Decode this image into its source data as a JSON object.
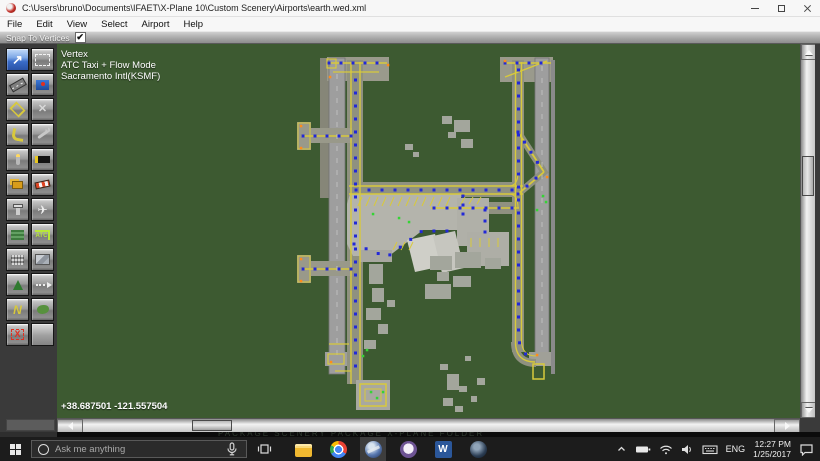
{
  "window": {
    "title": "C:\\Users\\bruno\\Documents\\IFAET\\X-Plane 10\\Custom Scenery\\Airports\\earth.wed.xml"
  },
  "menu": {
    "items": [
      "File",
      "Edit",
      "View",
      "Select",
      "Airport",
      "Help"
    ]
  },
  "snapbar": {
    "label": "Snap To Vertices",
    "checked": true,
    "check_glyph": "✔"
  },
  "palette": {
    "tools": [
      {
        "name": "vertex-tool",
        "label": "Vertex",
        "icon": "vertex",
        "glyph": "↗",
        "selected": true
      },
      {
        "name": "marquee-tool",
        "label": "Marquee",
        "icon": "marquee"
      },
      {
        "name": "runway-tool",
        "label": "Runway",
        "icon": "runway"
      },
      {
        "name": "sealane-tool",
        "label": "Sealane",
        "icon": "sealane"
      },
      {
        "name": "taxiway-tool",
        "label": "Taxiway",
        "icon": "taxiway"
      },
      {
        "name": "hole-tool",
        "label": "Hole",
        "icon": "hole",
        "glyph": "✕"
      },
      {
        "name": "taxiline-tool",
        "label": "Taxiline",
        "icon": "taxiline"
      },
      {
        "name": "boundary-tool",
        "label": "Boundary",
        "icon": "wrench"
      },
      {
        "name": "light-fixture-tool",
        "label": "Light Fixture",
        "icon": "light"
      },
      {
        "name": "sign-tool",
        "label": "Sign",
        "icon": "sign"
      },
      {
        "name": "object-tool",
        "label": "Object",
        "icon": "object"
      },
      {
        "name": "windsock-tool",
        "label": "Windsock",
        "icon": "windsock"
      },
      {
        "name": "tower-viewpoint-tool",
        "label": "Tower Viewpoint",
        "icon": "tower"
      },
      {
        "name": "ramp-start-tool",
        "label": "Ramp Start",
        "icon": "ramp",
        "glyph": "✈"
      },
      {
        "name": "orthophoto-tool",
        "label": "Orthophoto",
        "icon": "ortho"
      },
      {
        "name": "atc-taxi-route-tool",
        "label": "ATC Taxi Route",
        "icon": "atc",
        "glyph": "ATC"
      },
      {
        "name": "facade-tool",
        "label": "Facade",
        "icon": "facade"
      },
      {
        "name": "object-art-tool",
        "label": "Object Art",
        "icon": "objart"
      },
      {
        "name": "forest-tool",
        "label": "Forest",
        "icon": "forest"
      },
      {
        "name": "string-tool",
        "label": "String",
        "icon": "string"
      },
      {
        "name": "line-tool",
        "label": "Line",
        "icon": "line",
        "glyph": "N"
      },
      {
        "name": "polygon-tool",
        "label": "Polygon",
        "icon": "polygon"
      },
      {
        "name": "exclusion-zone-tool",
        "label": "Exclusion Zone",
        "icon": "exclusion",
        "glyph": "X"
      },
      {
        "name": "empty-slot",
        "label": "",
        "icon": "blank"
      }
    ]
  },
  "canvas": {
    "overlay": {
      "line1": "Vertex",
      "line2": "ATC Taxi + Flow Mode",
      "line3": "Sacramento Intl(KSMF)"
    },
    "coordinates": "+38.687501 -121.557504",
    "colors": {
      "background": "#3d5a31",
      "runway": "#9e9e9e",
      "taxi_yellow": "#d8c93c",
      "apron": "#b4b4ac",
      "node_blue": "#2228d8",
      "node_green": "#35d435",
      "node_orange": "#ff8c1a"
    },
    "map": {
      "shapes": [
        [
          "r",
          263,
          14,
          9,
          140,
          "#868678"
        ],
        [
          "r",
          270,
          13,
          62,
          24,
          "#9a9a8c"
        ],
        [
          "r",
          443,
          13,
          53,
          25,
          "#9a9a8c"
        ],
        [
          "r",
          272,
          14,
          16,
          316,
          "#9e9e9e",
          "#747474"
        ],
        [
          "r",
          290,
          16,
          16,
          324,
          "#8f9180"
        ],
        [
          "r",
          478,
          14,
          14,
          300,
          "#9e9e9e",
          "#747474"
        ],
        [
          "r",
          494,
          16,
          4,
          314,
          "#8a8a8a"
        ],
        [
          "r",
          455,
          16,
          12,
          292,
          "#8f9180"
        ],
        [
          "r",
          291,
          138,
          176,
          15,
          "#8f9180"
        ],
        [
          "r",
          373,
          158,
          93,
          12,
          "#8f9180"
        ],
        [
          "r",
          242,
          84,
          53,
          15,
          "#99998a"
        ],
        [
          "r",
          240,
          78,
          14,
          28,
          "#99998a"
        ],
        [
          "r",
          242,
          217,
          53,
          15,
          "#99998a"
        ],
        [
          "r",
          240,
          211,
          14,
          28,
          "#99998a"
        ],
        [
          "r",
          268,
          308,
          22,
          14,
          "#9e9e9e"
        ],
        [
          "r",
          472,
          308,
          22,
          14,
          "#a0a098"
        ],
        [
          "g",
          "293,150 404,150 404,186 366,186 332,212 296,212 290,200 290,160",
          "#b4b4ac"
        ],
        [
          "r",
          400,
          154,
          32,
          48,
          "#b0b0a8"
        ],
        [
          "r",
          410,
          188,
          42,
          34,
          "#aeaea6"
        ],
        [
          "r",
          303,
          206,
          32,
          12,
          "#a8a8a0"
        ],
        [
          "r",
          299,
          336,
          34,
          30,
          "#a8a8a0"
        ],
        [
          "g",
          "350,196 378,190 386,222 358,228",
          "#cfcfc8"
        ],
        [
          "g",
          "376,192 398,187 407,224 385,229",
          "#c6c6bf"
        ],
        [
          "r",
          385,
          72,
          10,
          8,
          "#a3a69c"
        ],
        [
          "r",
          397,
          76,
          16,
          12,
          "#a3a69c"
        ],
        [
          "r",
          391,
          88,
          8,
          6,
          "#a3a69c"
        ],
        [
          "r",
          404,
          95,
          12,
          9,
          "#a3a69c"
        ],
        [
          "r",
          348,
          100,
          8,
          6,
          "#a3a69c"
        ],
        [
          "r",
          356,
          108,
          6,
          5,
          "#a3a69c"
        ],
        [
          "r",
          373,
          212,
          22,
          14,
          "#a3a69c"
        ],
        [
          "r",
          398,
          208,
          26,
          16,
          "#a3a69c"
        ],
        [
          "r",
          428,
          214,
          16,
          11,
          "#a3a69c"
        ],
        [
          "r",
          380,
          228,
          12,
          9,
          "#a3a69c"
        ],
        [
          "r",
          368,
          240,
          26,
          15,
          "#a3a69c"
        ],
        [
          "r",
          396,
          232,
          18,
          11,
          "#a3a69c"
        ],
        [
          "r",
          312,
          220,
          14,
          20,
          "#a3a69c"
        ],
        [
          "r",
          315,
          244,
          12,
          14,
          "#a3a69c"
        ],
        [
          "r",
          309,
          264,
          15,
          12,
          "#a3a69c"
        ],
        [
          "r",
          321,
          280,
          10,
          10,
          "#a3a69c"
        ],
        [
          "r",
          307,
          296,
          12,
          9,
          "#a3a69c"
        ],
        [
          "r",
          330,
          256,
          8,
          7,
          "#a3a69c"
        ],
        [
          "r",
          383,
          320,
          8,
          6,
          "#a3a69c"
        ],
        [
          "r",
          390,
          330,
          12,
          16,
          "#a3a69c"
        ],
        [
          "r",
          402,
          342,
          8,
          6,
          "#a3a69c"
        ],
        [
          "r",
          386,
          354,
          10,
          8,
          "#a3a69c"
        ],
        [
          "r",
          398,
          362,
          8,
          6,
          "#a3a69c"
        ],
        [
          "r",
          408,
          312,
          6,
          5,
          "#a3a69c"
        ],
        [
          "r",
          420,
          334,
          8,
          7,
          "#a3a69c"
        ],
        [
          "r",
          414,
          352,
          6,
          6,
          "#a3a69c"
        ],
        [
          "p",
          "M461,88 L487,128 L461,150",
          "#8f9180",
          7
        ],
        [
          "p",
          "M458,298 C458,313 466,319 479,319",
          "#8f9180",
          8
        ],
        [
          "l",
          294,
          18,
          294,
          340,
          "Y",
          1.4
        ],
        [
          "l",
          303,
          18,
          303,
          336,
          "Y",
          1.4
        ],
        [
          "l",
          292,
          142,
          466,
          142,
          "Y",
          1.4
        ],
        [
          "l",
          292,
          150,
          466,
          150,
          "Y",
          1.4
        ],
        [
          "l",
          374,
          164,
          462,
          164,
          "Y",
          1.4
        ],
        [
          "l",
          458.5,
          18,
          458.5,
          298,
          "Y",
          1.4
        ],
        [
          "l",
          464.5,
          18,
          464.5,
          296,
          "Y",
          1.4
        ],
        [
          "l",
          244,
          92,
          295,
          92,
          "Y",
          1.4
        ],
        [
          "l",
          244,
          225,
          295,
          225,
          "Y",
          1.4
        ],
        [
          "l",
          272,
          19,
          330,
          19,
          "Y",
          1.4
        ],
        [
          "l",
          276,
          28,
          322,
          28,
          "Y",
          1.2
        ],
        [
          "l",
          446,
          19,
          494,
          19,
          "Y",
          1.4
        ],
        [
          "l",
          272,
          300,
          292,
          300,
          "Y",
          1.2
        ],
        [
          "l",
          278,
          327,
          294,
          327,
          "Y",
          1.2
        ],
        [
          "l",
          280,
          30,
          280,
          318,
          "#c6c6c6",
          0.8,
          "5,7"
        ],
        [
          "l",
          485,
          22,
          485,
          306,
          "#c6c6c6",
          0.8,
          "5,7"
        ],
        [
          "p",
          "M461,88 L487,128",
          "Y",
          1.8
        ],
        [
          "p",
          "M461,150 L487,128",
          "Y",
          1.8
        ],
        [
          "p",
          "M448,33 L490,17",
          "Y",
          1.4
        ],
        [
          "p",
          "M458.5,298 C458.5,312 466,318 478,318",
          "Y",
          1.4
        ],
        [
          "p",
          "M464.5,296 C464.5,307 470,312 479,312",
          "Y",
          1.1
        ],
        [
          "p",
          "M452,150 C460,150 461,158 461,164",
          "Y",
          1.1
        ],
        [
          "p",
          "M452,142 C460,142 461,134 461,128",
          "Y",
          1.1
        ],
        [
          "o",
          476,
          320,
          11,
          15,
          "Y",
          1.5
        ],
        [
          "o",
          303,
          340,
          26,
          22,
          "Y",
          1.5
        ],
        [
          "o",
          308,
          345,
          16,
          12,
          "Y",
          1
        ],
        [
          "o",
          270,
          15,
          9,
          9,
          "Y",
          1.2
        ],
        [
          "o",
          271,
          310,
          16,
          10,
          "Y",
          1.2
        ],
        [
          "o",
          241,
          79,
          12,
          26,
          "Y",
          1
        ],
        [
          "o",
          241,
          212,
          12,
          26,
          "Y",
          1
        ],
        [
          "t",
          301,
          162,
          4,
          -9,
          12,
          8,
          0
        ],
        [
          "t",
          404,
          160,
          4,
          -7,
          3,
          8,
          0
        ],
        [
          "t",
          414,
          194,
          0,
          9,
          4,
          9,
          0
        ],
        [
          "t",
          336,
          206,
          4,
          -8,
          3,
          8,
          0
        ]
      ],
      "routes": [
        {
          "pts": [
            [
              298.5,
              36
            ],
            [
              298.5,
              334
            ]
          ],
          "sp": 13
        },
        {
          "pts": [
            [
              299,
              146
            ],
            [
              463,
              146
            ]
          ],
          "sp": 13
        },
        {
          "pts": [
            [
              461.5,
              26
            ],
            [
              461.5,
              296
            ],
            [
              466,
              308
            ],
            [
              474,
              314
            ],
            [
              480,
              315
            ]
          ],
          "sp": 13
        },
        {
          "pts": [
            [
              377,
              164
            ],
            [
              460,
              164
            ]
          ],
          "sp": 13
        },
        {
          "pts": [
            [
              246,
              92
            ],
            [
              294,
              92
            ]
          ],
          "sp": 12
        },
        {
          "pts": [
            [
              246,
              225
            ],
            [
              294,
              225
            ]
          ],
          "sp": 12
        },
        {
          "pts": [
            [
              461,
              88
            ],
            [
              486,
              127
            ]
          ],
          "sp": 12
        },
        {
          "pts": [
            [
              461,
              150
            ],
            [
              486,
              128
            ]
          ],
          "sp": 12
        },
        {
          "pts": [
            [
              272,
              19
            ],
            [
              328,
              19
            ]
          ],
          "sp": 12
        },
        {
          "pts": [
            [
              448,
              19
            ],
            [
              492,
              19
            ]
          ],
          "sp": 12
        },
        {
          "pts": [
            [
              297,
              200
            ],
            [
              330,
              213
            ],
            [
              365,
              187
            ],
            [
              400,
              187
            ]
          ],
          "sp": 13
        },
        {
          "pts": [
            [
              428,
              166
            ],
            [
              428,
              190
            ]
          ],
          "sp": 11
        },
        {
          "pts": [
            [
              406,
              152
            ],
            [
              406,
              171
            ]
          ],
          "sp": 9
        }
      ],
      "green": [
        [
          316,
          170
        ],
        [
          342,
          174
        ],
        [
          352,
          178
        ],
        [
          486,
          152
        ],
        [
          489,
          158
        ],
        [
          480,
          166
        ],
        [
          314,
          348
        ],
        [
          320,
          354
        ],
        [
          326,
          348
        ],
        [
          310,
          306
        ],
        [
          306,
          312
        ]
      ],
      "orange": [
        [
          244,
          82
        ],
        [
          244,
          104
        ],
        [
          244,
          215
        ],
        [
          244,
          237
        ],
        [
          273,
          33
        ],
        [
          274,
          318
        ],
        [
          480,
          311
        ],
        [
          448,
          17
        ],
        [
          331,
          21
        ],
        [
          490,
          133
        ]
      ]
    }
  },
  "cutoff_text": "PACKAGE    SCENERY PACKAGE    X-PLANE FOLDER",
  "taskbar": {
    "search_placeholder": "Ask me anything",
    "apps": [
      {
        "name": "file-explorer"
      },
      {
        "name": "chrome"
      },
      {
        "name": "wed",
        "active": true,
        "word": ""
      },
      {
        "name": "github"
      },
      {
        "name": "word",
        "word": "W"
      },
      {
        "name": "x-plane"
      }
    ],
    "tray": {
      "language": "ENG",
      "time": "12:27 PM",
      "date": "1/25/2017"
    }
  }
}
